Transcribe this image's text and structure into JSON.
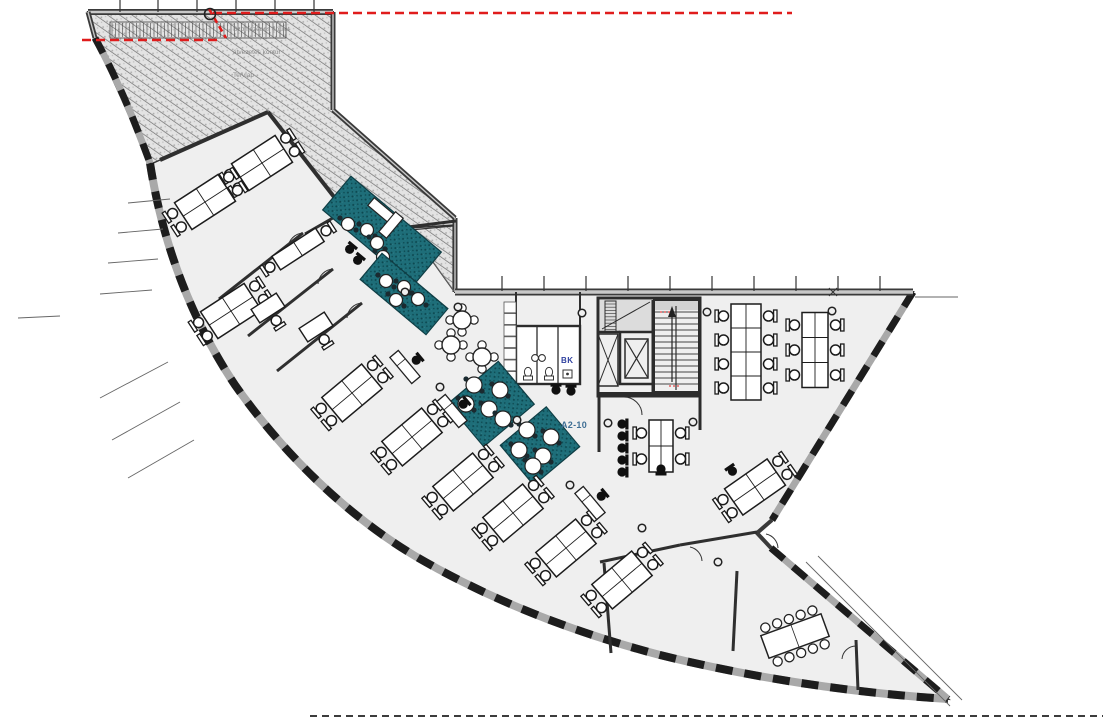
{
  "meta": {
    "drawing_type": "office floor plan"
  },
  "labels": {
    "room_code": "A2-10",
    "wc": "BK",
    "hatch_annotation": [
      "Szomszédos épület",
      "átvezetés kontúr",
      "Tervlap"
    ]
  },
  "colors": {
    "floor": "#efefef",
    "wall": "#333333",
    "band": "#a9a9a9",
    "teal": "#1e6e79",
    "red": "#e01c1c",
    "label_blue": "#3e6e94",
    "label_navy": "#2d3f9e",
    "chair_black": "#101010",
    "hatch_bg": "#e3e3e3"
  },
  "plan": {
    "outline": "M88,12 L333,12 L333,110 L455,218 L455,292 L913,292 L772,520 L757,533 L771,548 L948,699 C853,693 753,678 660,655 C568,631 485,597 415,556 C345,514 283,453 235,385 C193,322 163,247 150,163 L95,38 Z",
    "hatch1": "M88,14 L333,14 L333,110 L455,219 L455,225 L409,228 L345,211 L268,112 L160,160 L151,164 L95,40 Z",
    "hatch2": "M410,230 L453,226 L453,290 Z",
    "bands": [
      {
        "d": "M150,163 C163,247 193,322 235,385 C283,453 345,514 415,556 C485,597 568,631 660,655 C753,678 853,693 948,699",
        "w": 8
      },
      {
        "d": "M95,38 C118,80 135,122 150,163",
        "w": 7
      },
      {
        "d": "M913,292 L772,520",
        "w": 7
      },
      {
        "d": "M771,548 L948,699",
        "w": 7
      }
    ],
    "straight_walls": [
      {
        "d": "M88,12 L333,12",
        "w": 6
      },
      {
        "d": "M333,12 L333,110",
        "w": 5
      },
      {
        "d": "M333,110 L455,218",
        "w": 5
      },
      {
        "d": "M455,218 L455,292",
        "w": 5
      },
      {
        "d": "M455,292 L913,292",
        "w": 7
      },
      {
        "d": "M88,12 L95,38",
        "w": 5
      },
      {
        "d": "M772,520 L757,533 L771,548",
        "w": 4
      }
    ],
    "walls": [
      [
        160,
        160,
        268,
        112,
        4
      ],
      [
        268,
        112,
        345,
        211,
        4
      ],
      [
        345,
        211,
        408,
        227,
        3
      ],
      [
        408,
        227,
        456,
        221,
        3
      ],
      [
        345,
        211,
        305,
        234,
        3
      ],
      [
        303,
        233,
        219,
        299,
        3
      ],
      [
        333,
        269,
        248,
        336,
        3
      ],
      [
        362,
        303,
        277,
        371,
        3
      ],
      [
        600,
        562,
        680,
        545,
        3
      ],
      [
        680,
        545,
        757,
        532,
        3
      ],
      [
        604,
        563,
        611,
        653,
        3
      ],
      [
        737,
        571,
        733,
        651,
        3
      ],
      [
        856,
        640,
        858,
        690,
        3
      ],
      [
        516,
        292,
        516,
        326,
        2
      ],
      [
        580,
        292,
        580,
        326,
        2
      ]
    ],
    "thin": [
      [
        408,
        227,
        454,
        291
      ],
      [
        806,
        562,
        950,
        706
      ],
      [
        818,
        556,
        962,
        700
      ],
      [
        915,
        297,
        958,
        297
      ],
      [
        128,
        203,
        170,
        199
      ],
      [
        118,
        233,
        163,
        229
      ],
      [
        108,
        263,
        158,
        259
      ],
      [
        100,
        294,
        152,
        290
      ],
      [
        18,
        318,
        60,
        316
      ],
      [
        100,
        398,
        168,
        362
      ],
      [
        112,
        440,
        180,
        402
      ],
      [
        128,
        478,
        194,
        440
      ]
    ],
    "arcs": [
      "M522,327 A14 14 0 0 1 536,341",
      "M543,327 A14 14 0 0 1 557,341",
      "M564,327 A14 14 0 0 1 578,341",
      "M624,397 A18 18 0 0 1 642,415",
      "M303,233 A16 16 0 0 0 288,248",
      "M333,269 A16 16 0 0 0 318,284",
      "M362,303 A16 16 0 0 0 347,318",
      "M690,547 A15 15 0 0 1 702,561",
      "M766,534 A15 15 0 0 1 778,548",
      "M856,646 A14 14 0 0 0 842,659"
    ],
    "grate": {
      "x1": 112,
      "x2": 284,
      "y": 23,
      "h": 14,
      "step": 3.5
    },
    "teal": [
      {
        "cx": 382,
        "cy": 231,
        "w": 118,
        "h": 44,
        "rot": 40,
        "tr": 6.5,
        "tables": [
          [
            348,
            224
          ],
          [
            367,
            230
          ],
          [
            377,
            243
          ],
          [
            383,
            257
          ]
        ]
      },
      {
        "cx": 404,
        "cy": 294,
        "w": 86,
        "h": 34,
        "rot": 40,
        "tr": 6.5,
        "tables": [
          [
            386,
            281
          ],
          [
            404,
            287
          ],
          [
            396,
            300
          ],
          [
            418,
            299
          ]
        ]
      },
      {
        "cx": 491,
        "cy": 404,
        "w": 66,
        "h": 56,
        "rot": -40,
        "tr": 8,
        "tables": [
          [
            474,
            385
          ],
          [
            500,
            390
          ],
          [
            466,
            404
          ],
          [
            489,
            409
          ],
          [
            503,
            419
          ]
        ]
      },
      {
        "cx": 540,
        "cy": 446,
        "w": 60,
        "h": 52,
        "rot": -40,
        "tr": 8,
        "tables": [
          [
            527,
            430
          ],
          [
            551,
            437
          ],
          [
            519,
            450
          ],
          [
            543,
            456
          ],
          [
            533,
            466
          ]
        ]
      }
    ],
    "sofa": [
      {
        "cx": 381,
        "cy": 210,
        "w": 26,
        "h": 10,
        "rot": 40
      },
      {
        "cx": 391,
        "cy": 225,
        "w": 10,
        "h": 26,
        "rot": 40
      }
    ],
    "cafe": [
      [
        462,
        320
      ],
      [
        451,
        345
      ],
      [
        482,
        357
      ]
    ],
    "clusters": [
      [
        262,
        163,
        -33
      ],
      [
        205,
        202,
        -33
      ],
      [
        231,
        311,
        -33
      ],
      [
        298,
        249,
        -33,
        1
      ],
      [
        352,
        393,
        -40
      ],
      [
        412,
        437,
        -40
      ],
      [
        463,
        482,
        -40
      ],
      [
        513,
        513,
        -40
      ],
      [
        566,
        548,
        -40
      ],
      [
        622,
        580,
        -40
      ],
      [
        755,
        487,
        -35
      ],
      [
        661,
        446,
        0,
        2,
        2,
        12,
        26
      ],
      [
        746,
        352,
        0,
        4,
        2,
        15,
        24
      ],
      [
        815,
        350,
        0,
        3,
        2,
        13,
        25
      ]
    ],
    "singles": [
      [
        268,
        308,
        -33
      ],
      [
        316,
        327,
        -33
      ]
    ],
    "printers": [
      [
        405,
        367,
        50
      ],
      [
        452,
        411,
        50
      ],
      [
        590,
        503,
        50
      ]
    ],
    "black_chairs": [
      [
        349,
        250,
        40
      ],
      [
        357,
        261,
        40
      ],
      [
        556,
        391,
        0
      ],
      [
        571,
        392,
        0
      ],
      [
        661,
        468,
        180
      ],
      [
        733,
        472,
        -35
      ]
    ],
    "chair_col": {
      "x": 621,
      "y0": 424,
      "n": 5,
      "step": 12
    },
    "columns": [
      [
        405,
        292
      ],
      [
        440,
        387
      ],
      [
        517,
        420
      ],
      [
        570,
        485
      ],
      [
        642,
        528
      ],
      [
        608,
        423
      ],
      [
        693,
        422
      ],
      [
        707,
        312
      ],
      [
        832,
        311
      ],
      [
        718,
        562
      ],
      [
        582,
        313
      ],
      [
        458,
        307
      ]
    ],
    "conference": {
      "cx": 795,
      "cy": 636,
      "rot": -20,
      "w": 64,
      "h": 24,
      "n_side": 5
    },
    "core": {
      "fills": [
        [
          600,
          300,
          52,
          31,
          "#dcdcdc"
        ],
        [
          654,
          300,
          45,
          10,
          "#d2d2d2"
        ]
      ],
      "treads": {
        "x": 654,
        "w": 45,
        "y0": 312,
        "n": 13,
        "step": 6
      },
      "rungs": {
        "x": 605,
        "w": 11,
        "y0": 304,
        "n": 9,
        "step": 3.2
      },
      "rects": [
        [
          598,
          298,
          102,
          98,
          3
        ],
        [
          605,
          301,
          11,
          31,
          1
        ],
        [
          598,
          334,
          20,
          52,
          1.5
        ],
        [
          620,
          332,
          33,
          52,
          2.5
        ],
        [
          625,
          339,
          23,
          39,
          1.5
        ],
        [
          654,
          300,
          45,
          92,
          2
        ]
      ],
      "lines": [
        [
          653,
          300,
          653,
          394,
          3
        ],
        [
          598,
          332,
          620,
          332,
          2.5
        ],
        [
          602,
          329,
          650,
          302,
          1
        ],
        [
          625,
          339,
          648,
          378,
          1.2
        ],
        [
          648,
          339,
          625,
          378,
          1.2
        ],
        [
          598,
          334,
          618,
          386,
          1
        ],
        [
          618,
          334,
          598,
          386,
          1
        ],
        [
          676,
          306,
          676,
          390,
          1.2
        ],
        [
          598,
          394,
          700,
          394,
          4
        ],
        [
          599,
          396,
          599,
          452,
          3
        ],
        [
          700,
          396,
          700,
          430,
          3
        ]
      ],
      "arrow": {
        "x": 672,
        "y1": 382,
        "y2": 310
      }
    },
    "wc": {
      "rect": [
        516,
        326,
        64,
        58
      ],
      "lines": [
        [
          537,
          326,
          537,
          384,
          1.3
        ],
        [
          558,
          326,
          558,
          384,
          1.3
        ]
      ],
      "toilets": [
        [
          528,
          372
        ],
        [
          549,
          372
        ]
      ],
      "sinks": [
        [
          535,
          358
        ],
        [
          542,
          358
        ]
      ],
      "urinal": [
        563,
        370,
        9,
        8
      ]
    },
    "lockers": {
      "x": 504,
      "y": 302,
      "w": 12,
      "h": 11.6,
      "n": 7
    },
    "red": {
      "dashes": [
        [
          213,
          13,
          792,
          13
        ],
        [
          82,
          40,
          222,
          40
        ]
      ],
      "diag": [
        209,
        9,
        226,
        38
      ],
      "circle": [
        210,
        14,
        5.5
      ],
      "stair_marks": [
        [
          660,
          312,
          672,
          312
        ],
        [
          669,
          386,
          681,
          386
        ]
      ]
    },
    "ticks": {
      "top_left": {
        "xs": [
          120,
          158,
          197,
          236,
          275,
          314
        ],
        "y1": 0,
        "y2": 12
      },
      "wing": {
        "xs": [
          502,
          544,
          586,
          628,
          670,
          712,
          754,
          796,
          838,
          880
        ],
        "y1": 276,
        "y2": 291
      },
      "cross": [
        833,
        292
      ]
    },
    "bottom_dash": [
      310,
      716,
      1103,
      716
    ]
  }
}
